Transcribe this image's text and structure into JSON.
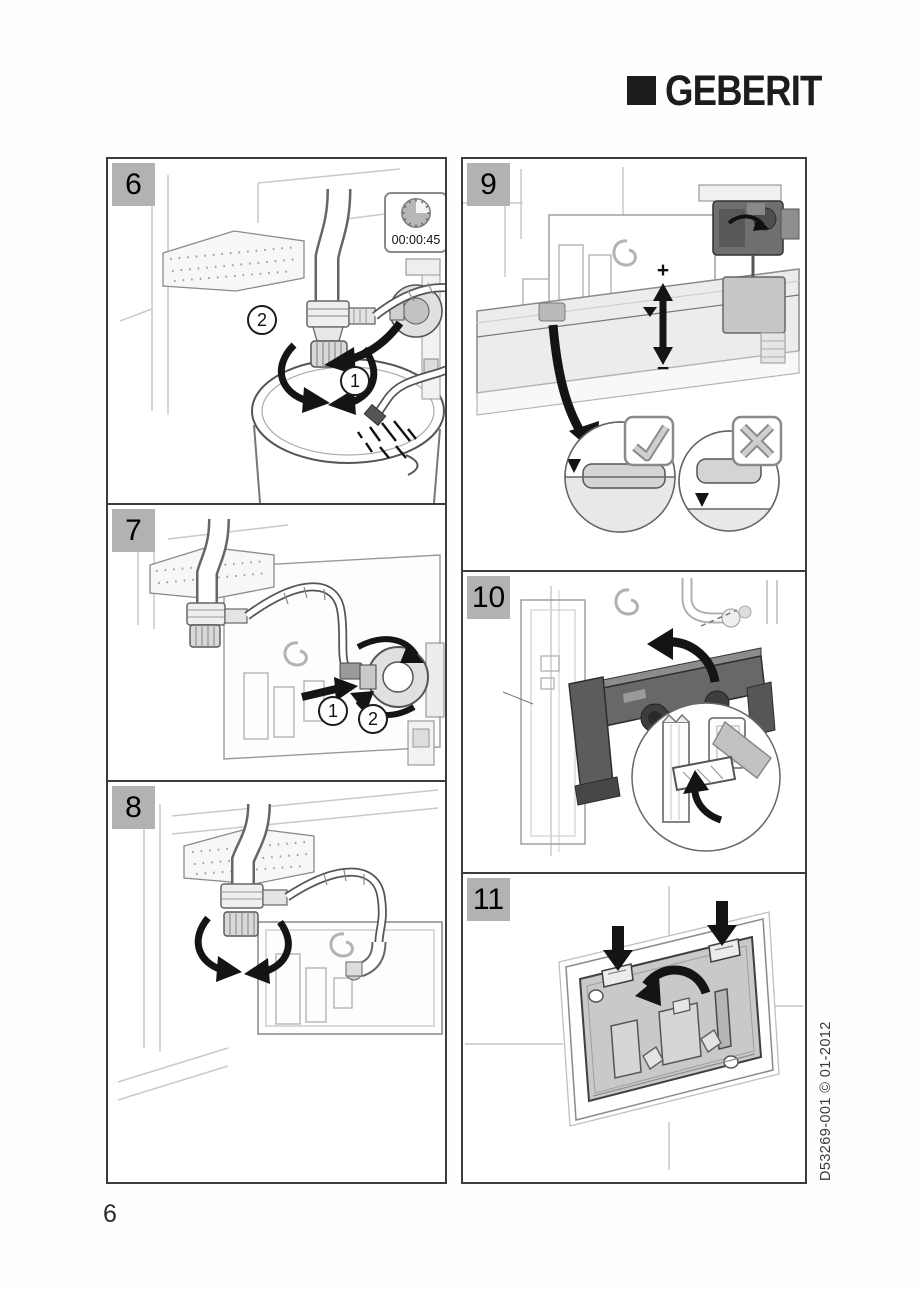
{
  "brand": {
    "logo_text": "GEBERIT"
  },
  "panels": [
    {
      "number": "6",
      "timer_value": "00:00:45",
      "callouts": [
        "1",
        "2"
      ]
    },
    {
      "number": "7",
      "callouts": [
        "1",
        "2"
      ]
    },
    {
      "number": "8"
    },
    {
      "number": "9",
      "adjust_plus": "+",
      "adjust_minus": "−"
    },
    {
      "number": "10"
    },
    {
      "number": "11"
    }
  ],
  "footer": {
    "page_number": "6"
  },
  "margin_code": "D53269-001 © 01-2012",
  "colors": {
    "panel_border": "#3c3c3c",
    "number_box_bg": "#b2b2b2",
    "logo_black": "#1c1c1c",
    "arrow_black": "#141414",
    "plate_gray": "#c9c9c9",
    "check_cross_gray": "#cfcfcf"
  }
}
